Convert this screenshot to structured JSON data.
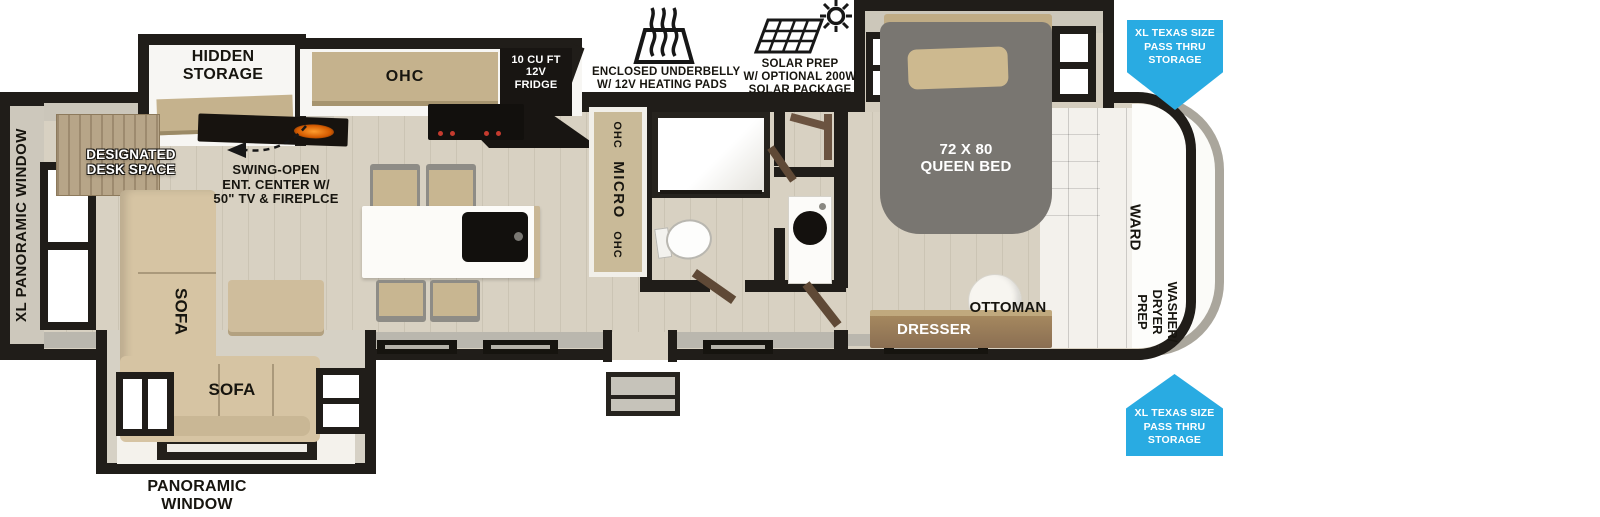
{
  "colors": {
    "accent_blue": "#29abe2",
    "wall_black": "#201d19",
    "floor_tan": "#d8d1c2",
    "cabinet_tan": "#c5b28d",
    "sofa_tan": "#d6c4a3",
    "bed_gray": "#797671",
    "dresser_brown": "#8a6e52",
    "appliance_black": "#14110e"
  },
  "icons": {
    "underbelly": {
      "line1": "ENCLOSED UNDERBELLY",
      "line2": "W/ 12V HEATING PADS"
    },
    "solar": {
      "line1": "SOLAR PREP",
      "line2": "W/ OPTIONAL 200W",
      "line3": "SOLAR PACKAGE"
    }
  },
  "callouts": {
    "pass_thru_top": {
      "line1": "XL TEXAS SIZE",
      "line2": "PASS THRU",
      "line3": "STORAGE"
    },
    "pass_thru_bottom": {
      "line1": "XL TEXAS SIZE",
      "line2": "PASS THRU",
      "line3": "STORAGE"
    }
  },
  "labels": {
    "hidden_storage": {
      "line1": "HIDDEN",
      "line2": "STORAGE"
    },
    "ohc": "OHC",
    "fridge": {
      "line1": "10 CU FT",
      "line2": "12V",
      "line3": "FRIDGE"
    },
    "micro": {
      "top": "OHC",
      "mid": "MICRO",
      "bottom": "OHC"
    },
    "queen_bed": {
      "line1": "72 X 80",
      "line2": "QUEEN BED"
    },
    "ward": "WARD",
    "washer_dryer": {
      "line1": "WASHER/",
      "line2": "DRYER",
      "line3": "PREP"
    },
    "ottoman": "OTTOMAN",
    "dresser": "DRESSER",
    "xl_panoramic_window": "XL PANORAMIC WINDOW",
    "panoramic_window": {
      "line1": "PANORAMIC",
      "line2": "WINDOW"
    },
    "designated_desk": {
      "line1": "DESIGNATED",
      "line2": "DESK SPACE"
    },
    "ent_center": {
      "line1": "SWING-OPEN",
      "line2": "ENT. CENTER W/",
      "line3": "50\" TV & FIREPLCE"
    },
    "sofa_vertical": "SOFA",
    "sofa_horizontal": "SOFA"
  }
}
